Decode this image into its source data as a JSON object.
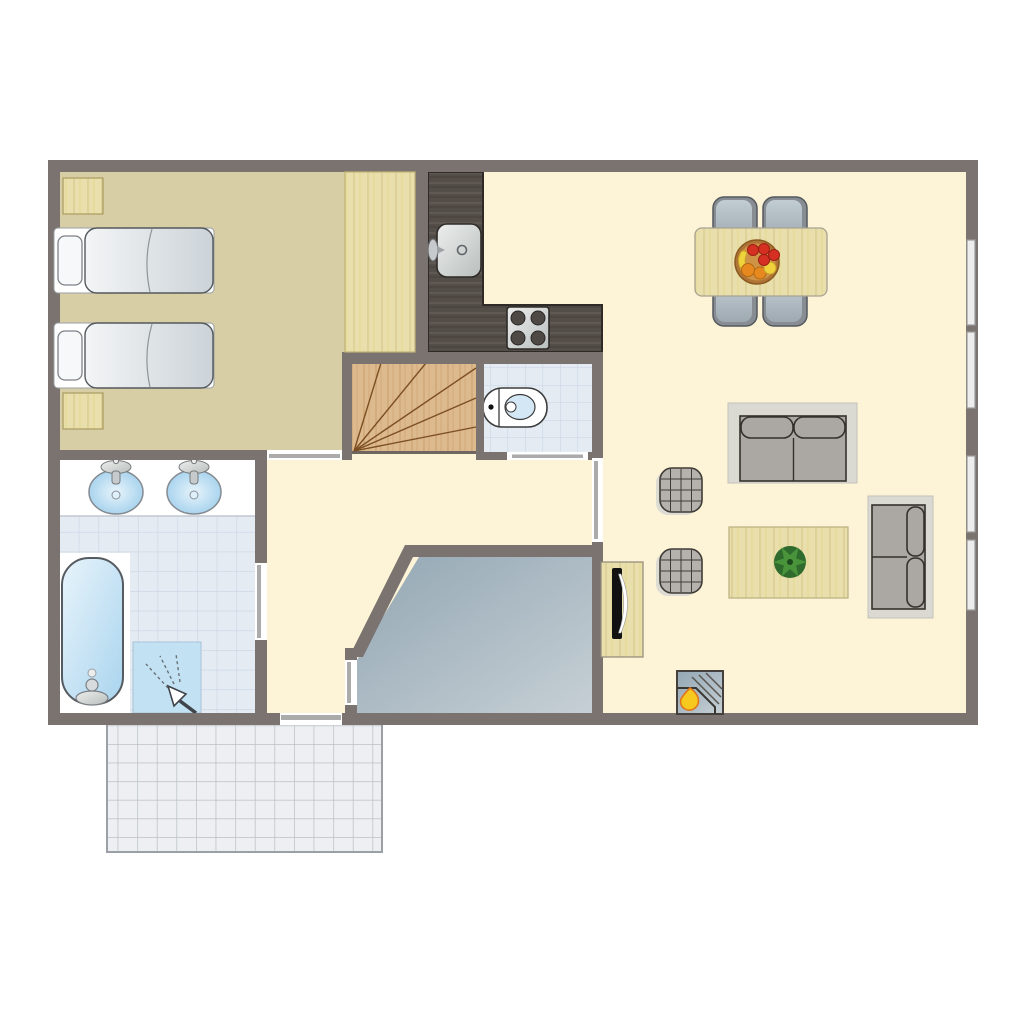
{
  "meta": {
    "kind": "apartment-floor-plan-top-view"
  },
  "palette": {
    "background": "#ffffff",
    "wall": "#7b7370",
    "floor_main": "#fdf3d6",
    "floor_bedroom": "#d8cea6",
    "wood_light": "#e9dfac",
    "wood_grain": "#d8ca8e",
    "stairs_wood": "#dcba8e",
    "stairs_grain": "#c99e6b",
    "stair_line": "#7c4f22",
    "counter_dark": "#544e49",
    "counter_grain": "#675f58",
    "counter_outline": "#2e2a27",
    "tile_fill": "#e4ebf3",
    "tile_line": "#c9d5e4",
    "terrace_fill": "#edeff2",
    "terrace_line": "#b9bfc5",
    "terrace_border": "#9aa0a6",
    "gray_room_dark": "#93a7b3",
    "gray_room_light": "#c6cfd5",
    "door_line": "#ababab",
    "window_fill": "#ededed",
    "window_stroke": "#9c9c9c",
    "fixture_white": "#ffffff",
    "water_blue_light": "#e8f4fb",
    "water_blue": "#a9d4ee",
    "shower_blue": "#c2e1f3",
    "metal_light": "#eceeed",
    "metal_dark": "#b9bfbd",
    "bed_light": "#f3f5f6",
    "bed_dark": "#ccd3d8",
    "sofa_frame": "#dadad2",
    "sofa_seat": "#aba8a3",
    "sofa_outline": "#35302c",
    "chair_light": "#c2ccd3",
    "chair_dark": "#9fa9b1",
    "chair_ring": "#878d93",
    "pouf_fill": "#b5b2ad",
    "pouf_line": "#3f3b37",
    "pouf_shadow": "#dcdbd4",
    "plant_dark": "#2e6b2c",
    "plant_light": "#49943b",
    "bowl_rim": "#b07436",
    "bowl_inner": "#cf9346",
    "fruit_red": "#d63022",
    "fruit_orange": "#e8891f",
    "fruit_yellow": "#f0d23c",
    "flame_yellow": "#f7c81e",
    "flame_orange": "#e0761c",
    "tv_black": "#111111",
    "toilet_bowl_blue": "#d3e7f5"
  },
  "inventory": {
    "rooms": [
      "bedroom",
      "kitchen",
      "dining-area",
      "living-room",
      "bathroom",
      "toilet-room",
      "hallway",
      "staircase",
      "storage-room",
      "terrace"
    ],
    "bedroom": [
      "single-bed",
      "single-bed",
      "nightstand",
      "nightstand",
      "wardrobe"
    ],
    "kitchen": [
      "l-shaped-counter",
      "kitchen-sink",
      "stove-four-burners"
    ],
    "toilet_room": [
      "toilet"
    ],
    "bathroom": [
      "washbasin",
      "washbasin",
      "bathtub",
      "shower"
    ],
    "dining_area": [
      "dining-table",
      "chair",
      "chair",
      "chair",
      "chair",
      "fruit-bowl"
    ],
    "living_room": [
      "two-seat-sofa",
      "two-seat-sofa",
      "coffee-table",
      "plant",
      "pouf",
      "pouf",
      "tv-cabinet",
      "fireplace"
    ],
    "staircase": [
      "winder-stairs"
    ],
    "terrace": [
      "tiled-patio"
    ],
    "openings": {
      "doors": [
        "bedroom-door",
        "bathroom-door",
        "toilet-door",
        "living-room-door",
        "storage-room-door",
        "terrace-sliding-door"
      ],
      "windows_right_wall": 4
    }
  }
}
